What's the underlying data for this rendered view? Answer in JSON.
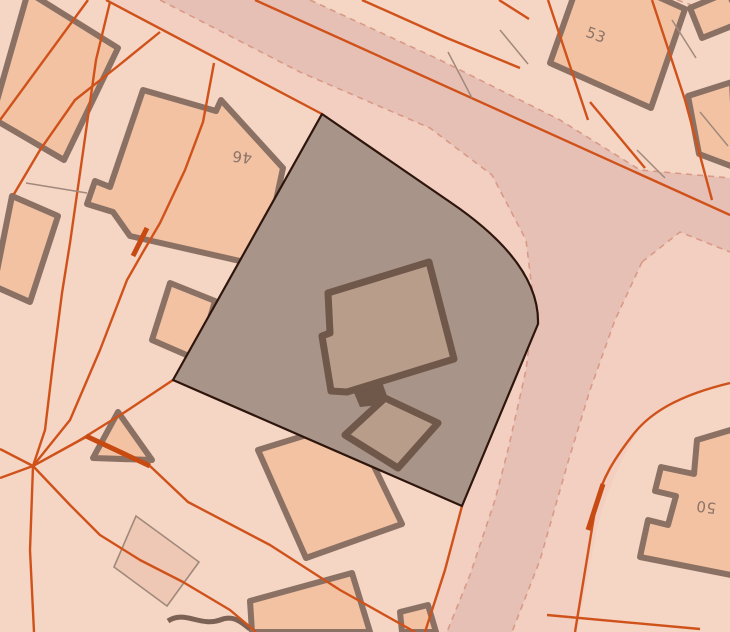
{
  "map": {
    "description": "cadastral-street-map-tile",
    "labels": [
      {
        "id": "house-46",
        "text": "46"
      },
      {
        "id": "house-53",
        "text": "53"
      },
      {
        "id": "house-50",
        "text": "50"
      }
    ],
    "colors": {
      "background_parcels": "#f5d5c4",
      "road_pavement": "#f2cfc1",
      "road_surface": "#e7c0b5",
      "parcel_boundary_orange": "#d0521b",
      "parcel_boundary_orange_thick": "#c64a12",
      "road_edge_dashed": "#d89a87",
      "fence_gray": "#a0897b",
      "highlight_parcel_fill": "#a9948a",
      "highlight_parcel_outline": "#2e160d",
      "building_fill": "#f2c2a3",
      "building_outline": "#8b7164",
      "highlight_building_fill": "#b89d8b",
      "highlight_building_outline": "#6f574a",
      "label_text": "#8c7467"
    }
  }
}
